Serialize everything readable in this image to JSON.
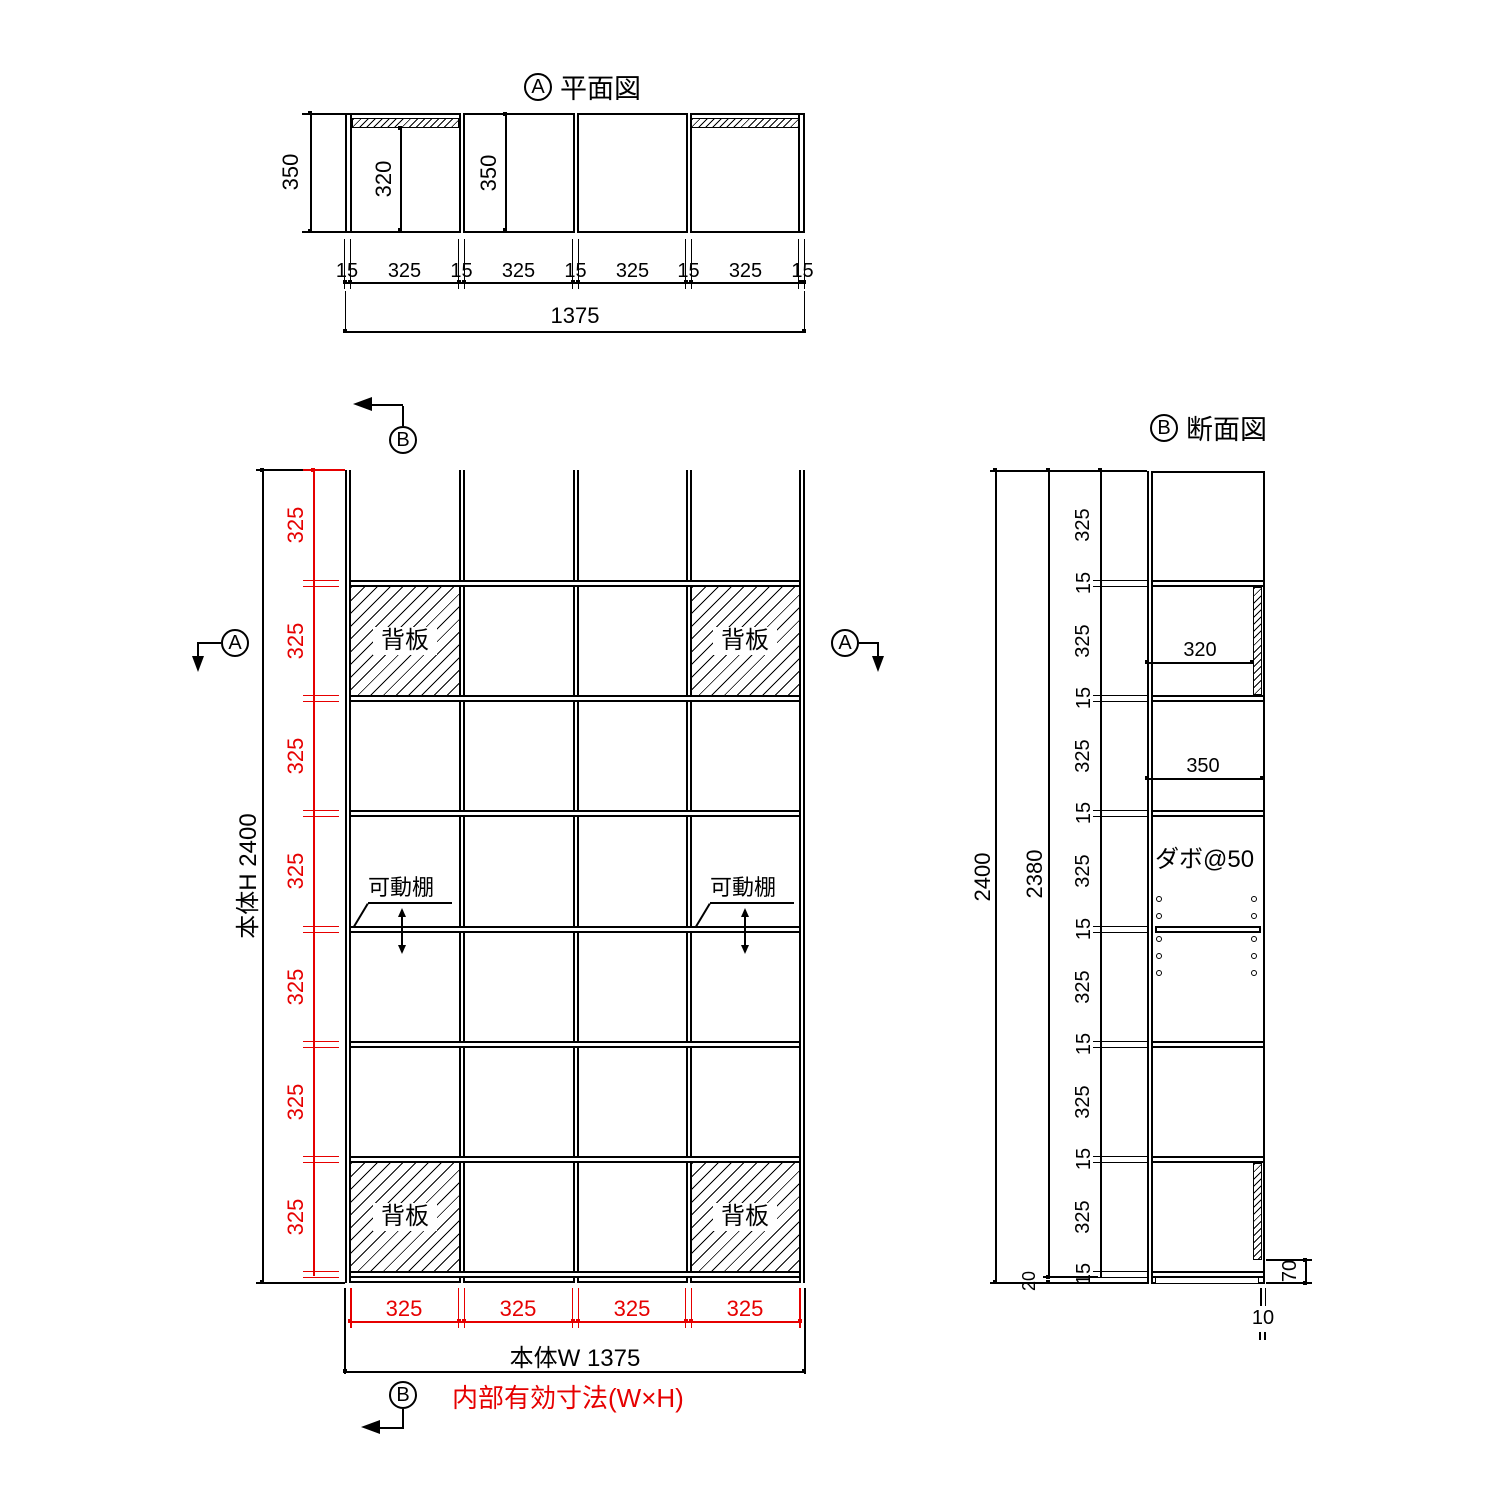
{
  "colors": {
    "line": "#000000",
    "dimension_accent": "#e60000"
  },
  "plan_view": {
    "marker": "A",
    "title": "平面図",
    "dim_depth_overall": "350",
    "dim_back_clearance": "320",
    "dim_depth_inner": "350",
    "bottom_chain": [
      "15",
      "325",
      "15",
      "325",
      "15",
      "325",
      "15",
      "325",
      "15"
    ],
    "dim_width_overall": "1375"
  },
  "elevation_view": {
    "marker_a": "A",
    "marker_b": "B",
    "dim_height_overall": "本体H 2400",
    "dim_width_overall": "本体W 1375",
    "row_dims": [
      "325",
      "325",
      "325",
      "325",
      "325",
      "325",
      "325"
    ],
    "col_dims": [
      "325",
      "325",
      "325",
      "325"
    ],
    "back_panel_label": "背板",
    "movable_shelf_label": "可動棚",
    "note_internal": "内部有効寸法(W×H)"
  },
  "section_view": {
    "marker": "B",
    "title": "断面図",
    "dim_height_overall": "2400",
    "dim_height_inner": "2380",
    "row_dims": [
      "325",
      "325",
      "325",
      "325",
      "325",
      "325",
      "325"
    ],
    "shelf_thickness": "15",
    "dim_back_clearance": "320",
    "dim_depth_inner": "350",
    "dowel_note": "ダボ@50",
    "dim_bottom_panel": "20",
    "dim_base_height": "70",
    "dim_back_gap": "10"
  }
}
